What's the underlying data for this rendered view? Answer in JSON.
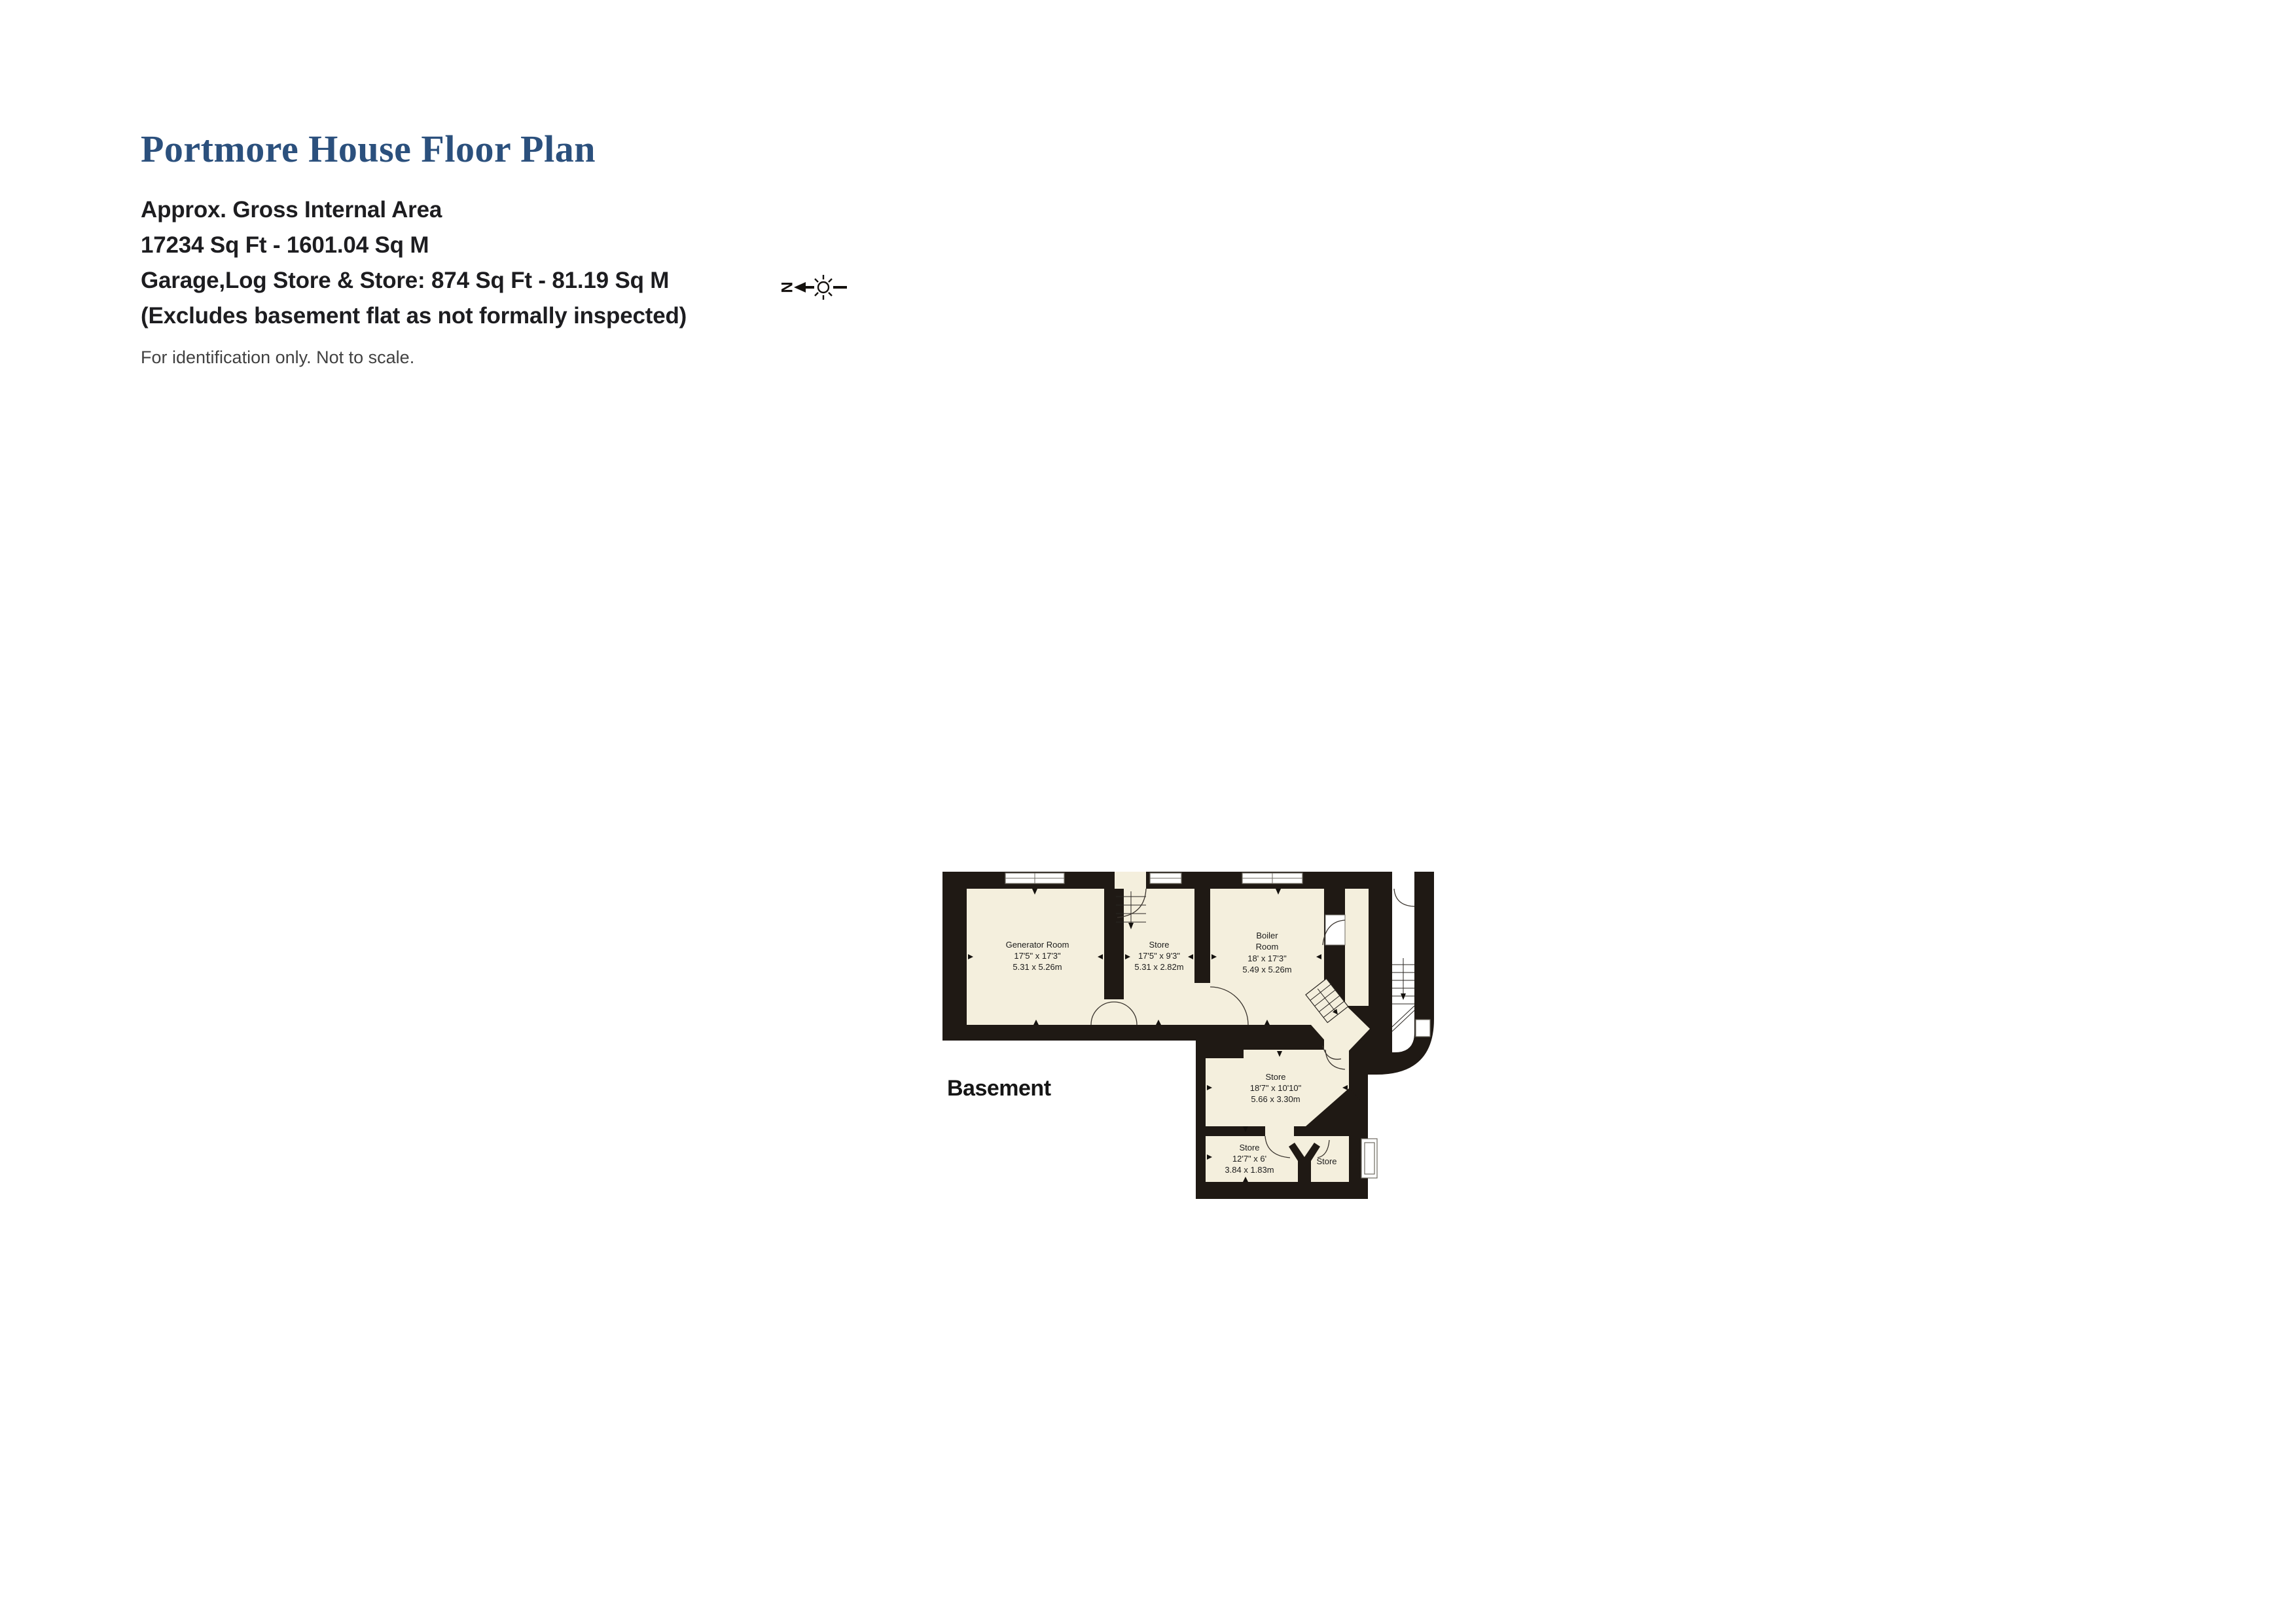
{
  "header": {
    "title": "Portmore House Floor Plan",
    "area_lines": [
      "Approx. Gross Internal Area",
      "17234 Sq Ft - 1601.04 Sq M",
      "Garage,Log Store & Store: 874 Sq Ft - 81.19 Sq M",
      "(Excludes basement flat as not formally inspected)"
    ],
    "disclaimer": "For identification only. Not to scale."
  },
  "compass": {
    "north_label": "N"
  },
  "floor": {
    "label": "Basement"
  },
  "theme": {
    "title_blue": "#2b507d",
    "wall": "#1f1914",
    "room_fill": "#f4efdd"
  },
  "plan": {
    "rooms": {
      "generator": {
        "name": "Generator Room",
        "dims_ft": "17'5\" x 17'3\"",
        "dims_m": "5.31 x 5.26m"
      },
      "store_top": {
        "name": "Store",
        "dims_ft": "17'5\" x 9'3\"",
        "dims_m": "5.31 x 2.82m"
      },
      "boiler": {
        "name1": "Boiler",
        "name2": "Room",
        "dims_ft": "18' x 17'3\"",
        "dims_m": "5.49 x 5.26m"
      },
      "store_mid": {
        "name": "Store",
        "dims_ft": "18'7\" x 10'10\"",
        "dims_m": "5.66 x 3.30m"
      },
      "store_bottom": {
        "name": "Store",
        "dims_ft": "12'7\" x 6'",
        "dims_m": "3.84 x 1.83m"
      },
      "store_small": {
        "name": "Store"
      }
    }
  }
}
